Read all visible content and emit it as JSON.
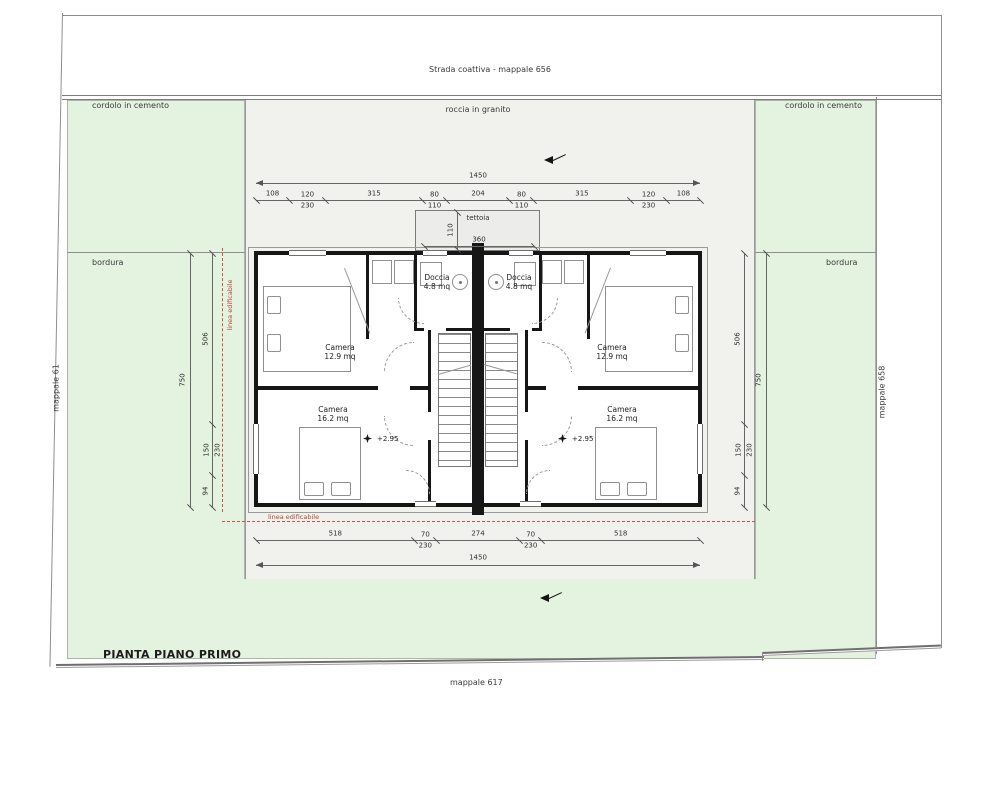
{
  "title": "PIANTA PIANO PRIMO",
  "site": {
    "road": "Strada coattiva - mappale 656",
    "road_edge": "roccia in granito",
    "curb_left": "cordolo in cemento",
    "curb_right": "cordolo in cemento",
    "border_left": "bordura",
    "border_right": "bordura",
    "parcel_left": "mappale 61",
    "parcel_right": "mappale 658",
    "parcel_bottom": "mappale 617",
    "building_line": "linea edificabile",
    "building_line_side": "linea edificabile"
  },
  "plan": {
    "canopy_label": "tettoia",
    "canopy_width": "360",
    "canopy_depth": "110",
    "rooms": {
      "left_top": {
        "name": "Camera",
        "area": "12.9 mq"
      },
      "left_bottom": {
        "name": "Camera",
        "area": "16.2 mq"
      },
      "left_doccia": {
        "name": "Doccia",
        "area": "4.8 mq"
      },
      "right_top": {
        "name": "Camera",
        "area": "12.9 mq"
      },
      "right_bottom": {
        "name": "Camera",
        "area": "16.2 mq"
      },
      "right_doccia": {
        "name": "Doccia",
        "area": "4.8 mq"
      }
    },
    "levels": {
      "left": "+2.95",
      "right": "+2.95"
    }
  },
  "dims": {
    "top_total": "1450",
    "top_segments": [
      "108",
      "120/230",
      "315",
      "80/110",
      "204",
      "80/110",
      "315",
      "120/230",
      "108"
    ],
    "bottom_segments": [
      "518",
      "70/230",
      "274",
      "70/230",
      "518"
    ],
    "bottom_total": "1450",
    "side_outer_left": "750",
    "side_outer_right": "750",
    "side_segments": [
      "506",
      "150/230",
      "94"
    ]
  },
  "colors": {
    "lot_green": "#e4f2e0",
    "strip_grey": "#f1f1ee",
    "wall": "#161616",
    "red_line": "#c4554a"
  }
}
